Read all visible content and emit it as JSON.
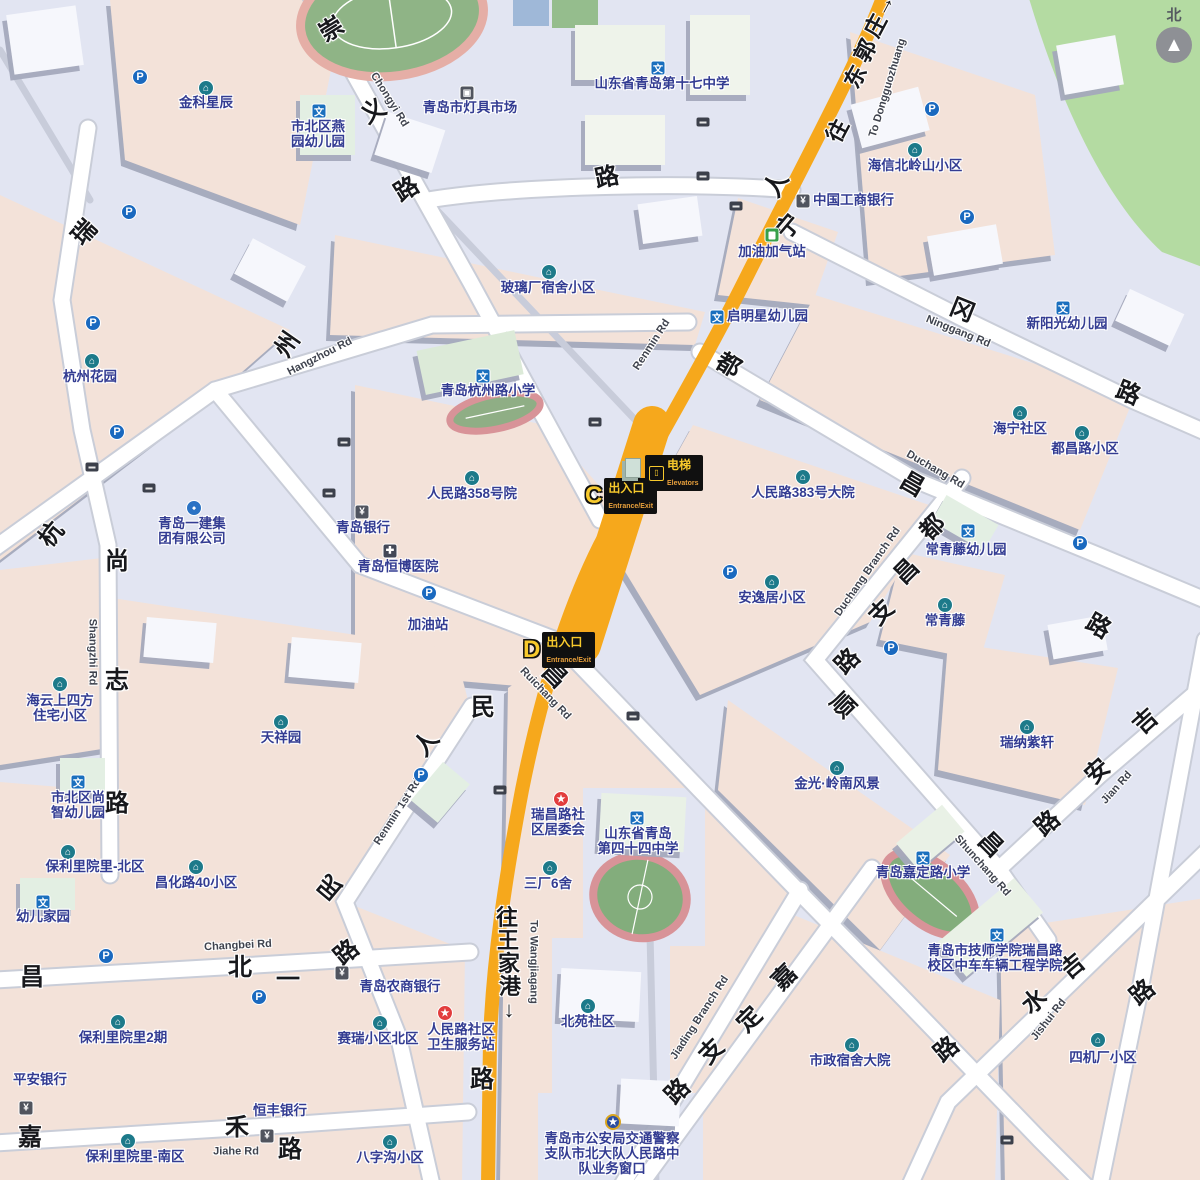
{
  "compass": {
    "label": "北"
  },
  "colors": {
    "background": "#e2e5f2",
    "block_pink": "#f3e2d9",
    "park_green": "#b4dba2",
    "main_road_yellow": "#f6a81c",
    "minor_road": "#ffffff",
    "poi_text": "#333c92",
    "street_text": "#17181c",
    "metro_badge_bg": "#101010",
    "metro_yellow": "#f7c92c"
  },
  "station": {
    "entrance_c": {
      "letter": "C",
      "label": "出入口",
      "sublabel": "Entrance/Exit"
    },
    "entrance_d": {
      "letter": "D",
      "label": "出入口",
      "sublabel": "Entrance/Exit"
    },
    "elevator": {
      "label": "电梯",
      "sublabel": "Elevators"
    }
  },
  "streets": [
    {
      "id": "chongyi-rd",
      "chars": [
        {
          "c": "崇",
          "x": 332,
          "y": 30,
          "r": -32
        },
        {
          "c": "义",
          "x": 374,
          "y": 112,
          "r": -32
        },
        {
          "c": "路",
          "x": 407,
          "y": 190,
          "r": -32
        }
      ],
      "en": {
        "t": "Chongyi Rd",
        "x": 389,
        "y": 100,
        "r": 58
      }
    },
    {
      "id": "rui-char",
      "chars": [
        {
          "c": "瑞",
          "x": 85,
          "y": 233,
          "r": -48
        }
      ]
    },
    {
      "id": "hangzhou-rd",
      "chars": [
        {
          "c": "杭",
          "x": 52,
          "y": 535,
          "r": -50
        },
        {
          "c": "州",
          "x": 288,
          "y": 345,
          "r": -55
        }
      ],
      "en": {
        "t": "Hangzhou Rd",
        "x": 320,
        "y": 357,
        "r": -27
      }
    },
    {
      "id": "shangzhi-rd",
      "chars": [
        {
          "c": "尚",
          "x": 117,
          "y": 562,
          "r": 0
        },
        {
          "c": "志",
          "x": 117,
          "y": 681,
          "r": 0
        },
        {
          "c": "路",
          "x": 117,
          "y": 804,
          "r": 0
        }
      ],
      "en": {
        "t": "Shangzhi Rd",
        "x": 92,
        "y": 652,
        "r": 90
      }
    },
    {
      "id": "lu-top",
      "chars": [
        {
          "c": "路",
          "x": 607,
          "y": 178,
          "r": -12
        }
      ]
    },
    {
      "id": "renmin-rd",
      "chars": [
        {
          "c": "人",
          "x": 777,
          "y": 185,
          "r": -60
        },
        {
          "c": "民",
          "x": 483,
          "y": 708,
          "r": 0
        },
        {
          "c": "路",
          "x": 482,
          "y": 1080,
          "r": 0
        }
      ],
      "en": {
        "t": "Renmin Rd",
        "x": 652,
        "y": 345,
        "r": -57
      }
    },
    {
      "id": "ninggang-rd",
      "chars": [
        {
          "c": "宁",
          "x": 789,
          "y": 227,
          "r": -50
        },
        {
          "c": "冈",
          "x": 962,
          "y": 311,
          "r": 22
        },
        {
          "c": "路",
          "x": 1128,
          "y": 394,
          "r": 22
        }
      ],
      "en": {
        "t": "Ninggang Rd",
        "x": 958,
        "y": 332,
        "r": 22
      }
    },
    {
      "id": "duchang-rd",
      "chars": [
        {
          "c": "都",
          "x": 728,
          "y": 366,
          "r": 30
        },
        {
          "c": "昌",
          "x": 912,
          "y": 485,
          "r": 30
        }
      ],
      "en": {
        "t": "Duchang Rd",
        "x": 935,
        "y": 470,
        "r": 30
      }
    },
    {
      "id": "duchang-branch-rd",
      "chars": [
        {
          "c": "都",
          "x": 933,
          "y": 528,
          "r": -45
        },
        {
          "c": "昌",
          "x": 907,
          "y": 572,
          "r": -45
        },
        {
          "c": "支",
          "x": 882,
          "y": 613,
          "r": -45
        },
        {
          "c": "路",
          "x": 848,
          "y": 662,
          "r": -45
        }
      ],
      "en": {
        "t": "Duchang Branch Rd",
        "x": 868,
        "y": 572,
        "r": -55
      }
    },
    {
      "id": "ruichang-rd",
      "chars": [
        {
          "c": "昌",
          "x": 554,
          "y": 676,
          "r": 45
        }
      ],
      "en": {
        "t": "Ruichang Rd",
        "x": 545,
        "y": 694,
        "r": 46
      }
    },
    {
      "id": "renmin-1st-rd",
      "chars": [
        {
          "c": "人",
          "x": 427,
          "y": 744,
          "r": -50
        },
        {
          "c": "民",
          "x": 330,
          "y": 886,
          "r": -140
        },
        {
          "c": "路",
          "x": 347,
          "y": 953,
          "r": -40
        }
      ],
      "en": {
        "t": "Renmin 1st Rd",
        "x": 398,
        "y": 812,
        "r": -57
      }
    },
    {
      "id": "changbei-rd",
      "chars": [
        {
          "c": "昌",
          "x": 32,
          "y": 978,
          "r": 0
        },
        {
          "c": "北",
          "x": 240,
          "y": 968,
          "r": 0
        },
        {
          "c": "一",
          "x": 288,
          "y": 980,
          "r": 0
        }
      ],
      "en": {
        "t": "Changbei Rd",
        "x": 238,
        "y": 946,
        "r": -3
      }
    },
    {
      "id": "jiahe-rd",
      "chars": [
        {
          "c": "嘉",
          "x": 30,
          "y": 1138,
          "r": 0
        },
        {
          "c": "禾",
          "x": 237,
          "y": 1128,
          "r": 0
        },
        {
          "c": "路",
          "x": 290,
          "y": 1150,
          "r": 0
        }
      ],
      "en": {
        "t": "Jiahe Rd",
        "x": 236,
        "y": 1152,
        "r": 0
      }
    },
    {
      "id": "jiading-branch-rd",
      "chars": [
        {
          "c": "支",
          "x": 712,
          "y": 1052,
          "r": -45
        },
        {
          "c": "路",
          "x": 678,
          "y": 1092,
          "r": -45
        }
      ],
      "en": {
        "t": "Jiading Branch Rd",
        "x": 700,
        "y": 1018,
        "r": -57
      }
    },
    {
      "id": "jiading-rd",
      "chars": [
        {
          "c": "嘉",
          "x": 785,
          "y": 978,
          "r": -45
        },
        {
          "c": "定",
          "x": 750,
          "y": 1020,
          "r": -45
        }
      ]
    },
    {
      "id": "jishui-rd",
      "chars": [
        {
          "c": "吉",
          "x": 1073,
          "y": 967,
          "r": -40
        },
        {
          "c": "水",
          "x": 1035,
          "y": 1002,
          "r": -40
        },
        {
          "c": "路",
          "x": 947,
          "y": 1050,
          "r": -40
        }
      ],
      "en": {
        "t": "Jishui Rd",
        "x": 1049,
        "y": 1020,
        "r": -52
      }
    },
    {
      "id": "shunchang-rd",
      "chars": [
        {
          "c": "顺",
          "x": 842,
          "y": 706,
          "r": 45
        },
        {
          "c": "昌",
          "x": 990,
          "y": 845,
          "r": 45
        }
      ],
      "en": {
        "t": "Shunchang Rd",
        "x": 982,
        "y": 866,
        "r": 48
      }
    },
    {
      "id": "jian-rd",
      "chars": [
        {
          "c": "吉",
          "x": 1146,
          "y": 722,
          "r": -42
        },
        {
          "c": "安",
          "x": 1098,
          "y": 772,
          "r": -42
        },
        {
          "c": "路",
          "x": 1048,
          "y": 824,
          "r": -42
        }
      ],
      "en": {
        "t": "Jian Rd",
        "x": 1117,
        "y": 788,
        "r": -48
      }
    },
    {
      "id": "lu-right-upper",
      "chars": [
        {
          "c": "路",
          "x": 1098,
          "y": 627,
          "r": 30
        }
      ]
    },
    {
      "id": "lu-right-lower",
      "chars": [
        {
          "c": "路",
          "x": 1143,
          "y": 993,
          "r": -40
        }
      ]
    },
    {
      "id": "to-dongguozhuang",
      "dir": true,
      "chars": [
        {
          "c": "往",
          "x": 838,
          "y": 131,
          "r": -62
        },
        {
          "c": "东",
          "x": 856,
          "y": 77,
          "r": -62
        },
        {
          "c": "郭",
          "x": 866,
          "y": 51,
          "r": -62
        },
        {
          "c": "庄",
          "x": 876,
          "y": 26,
          "r": -62
        },
        {
          "c": "→",
          "x": 884,
          "y": 5,
          "r": -62
        }
      ],
      "en": {
        "t": "To Dongguozhuang",
        "x": 888,
        "y": 88,
        "r": -73
      }
    },
    {
      "id": "to-wangjiagang",
      "dir": true,
      "chars": [
        {
          "c": "往",
          "x": 507,
          "y": 918,
          "r": 0
        },
        {
          "c": "王",
          "x": 508,
          "y": 941,
          "r": 0
        },
        {
          "c": "家",
          "x": 509,
          "y": 964,
          "r": 0
        },
        {
          "c": "港",
          "x": 510,
          "y": 987,
          "r": 0
        },
        {
          "c": "↓",
          "x": 509,
          "y": 1010,
          "r": 0
        }
      ],
      "en": {
        "t": "To Wangjiagang",
        "x": 533,
        "y": 962,
        "r": 90
      }
    }
  ],
  "places": [
    {
      "id": "jinke-xingchen",
      "icon": "community",
      "ix": 206,
      "iy": 88,
      "lines": [
        "金科星辰"
      ],
      "tx": 206,
      "ty": 96
    },
    {
      "id": "hangzhou-garden",
      "icon": "community",
      "ix": 92,
      "iy": 361,
      "lines": [
        "杭州花园"
      ],
      "tx": 90,
      "ty": 370
    },
    {
      "id": "haiyun-sifang",
      "icon": "community",
      "ix": 60,
      "iy": 684,
      "lines": [
        "海云上四方",
        "住宅小区"
      ],
      "tx": 60,
      "ty": 694
    },
    {
      "id": "tianxiang-yuan",
      "icon": "community",
      "ix": 281,
      "iy": 722,
      "lines": [
        "天祥园"
      ],
      "tx": 281,
      "ty": 731
    },
    {
      "id": "baoli-north",
      "icon": "community",
      "ix": 68,
      "iy": 852,
      "lines": [
        "保利里院里-北区"
      ],
      "tx": 95,
      "ty": 860
    },
    {
      "id": "changhua-40",
      "icon": "community",
      "ix": 196,
      "iy": 867,
      "lines": [
        "昌化路40小区"
      ],
      "tx": 196,
      "ty": 876
    },
    {
      "id": "baoli-phase2",
      "icon": "community",
      "ix": 118,
      "iy": 1022,
      "lines": [
        "保利里院里2期"
      ],
      "tx": 123,
      "ty": 1031
    },
    {
      "id": "baoli-south",
      "icon": "community",
      "ix": 128,
      "iy": 1141,
      "lines": [
        "保利里院里-南区"
      ],
      "tx": 135,
      "ty": 1150
    },
    {
      "id": "sairui-north",
      "icon": "community",
      "ix": 380,
      "iy": 1023,
      "lines": [
        "赛瑞小区北区"
      ],
      "tx": 378,
      "ty": 1032
    },
    {
      "id": "bazigou",
      "icon": "community",
      "ix": 390,
      "iy": 1142,
      "lines": [
        "八字沟小区"
      ],
      "tx": 390,
      "ty": 1151
    },
    {
      "id": "sanchang-6she",
      "icon": "community",
      "ix": 550,
      "iy": 868,
      "lines": [
        "三厂6舍"
      ],
      "tx": 548,
      "ty": 877
    },
    {
      "id": "beiyuan",
      "icon": "community",
      "ix": 588,
      "iy": 1006,
      "lines": [
        "北苑社区"
      ],
      "tx": 588,
      "ty": 1015
    },
    {
      "id": "jinguang-lingnan",
      "icon": "community",
      "ix": 837,
      "iy": 768,
      "lines": [
        "金光·岭南风景"
      ],
      "tx": 837,
      "ty": 777
    },
    {
      "id": "ruina-zixuan",
      "icon": "community",
      "ix": 1027,
      "iy": 727,
      "lines": [
        "瑞纳紫轩"
      ],
      "tx": 1027,
      "ty": 736
    },
    {
      "id": "changqingteng",
      "icon": "community",
      "ix": 945,
      "iy": 605,
      "lines": [
        "常青藤"
      ],
      "tx": 945,
      "ty": 614
    },
    {
      "id": "haining",
      "icon": "community",
      "ix": 1020,
      "iy": 413,
      "lines": [
        "海宁社区"
      ],
      "tx": 1020,
      "ty": 422
    },
    {
      "id": "duchanglu-xiaoqu",
      "icon": "community",
      "ix": 1082,
      "iy": 433,
      "lines": [
        "都昌路小区"
      ],
      "tx": 1085,
      "ty": 442
    },
    {
      "id": "renminlu-383",
      "icon": "community",
      "ix": 803,
      "iy": 477,
      "lines": [
        "人民路383号大院"
      ],
      "tx": 803,
      "ty": 486
    },
    {
      "id": "anyiju",
      "icon": "community",
      "ix": 772,
      "iy": 582,
      "lines": [
        "安逸居小区"
      ],
      "tx": 772,
      "ty": 591
    },
    {
      "id": "renminlu-358",
      "icon": "community",
      "ix": 472,
      "iy": 478,
      "lines": [
        "人民路358号院"
      ],
      "tx": 472,
      "ty": 487
    },
    {
      "id": "bolichang-sushe",
      "icon": "community",
      "ix": 549,
      "iy": 272,
      "lines": [
        "玻璃厂宿舍小区"
      ],
      "tx": 548,
      "ty": 281
    },
    {
      "id": "haixin-beilingshan",
      "icon": "community",
      "ix": 915,
      "iy": 150,
      "lines": [
        "海信北岭山小区"
      ],
      "tx": 915,
      "ty": 159
    },
    {
      "id": "shizheng-dayuan",
      "icon": "community",
      "ix": 852,
      "iy": 1045,
      "lines": [
        "市政宿舍大院"
      ],
      "tx": 850,
      "ty": 1054
    },
    {
      "id": "sijichang",
      "icon": "community",
      "ix": 1098,
      "iy": 1040,
      "lines": [
        "四机厂小区"
      ],
      "tx": 1103,
      "ty": 1051
    },
    {
      "id": "yijian-group",
      "icon": "company",
      "ix": 194,
      "iy": 508,
      "lines": [
        "青岛一建集",
        "团有限公司"
      ],
      "tx": 192,
      "ty": 517
    },
    {
      "id": "dengju-market",
      "icon": "shop",
      "ix": 467,
      "iy": 93,
      "lines": [
        "青岛市灯具市场"
      ],
      "tx": 470,
      "ty": 101
    },
    {
      "id": "no17-middle-school",
      "icon": "school",
      "ix": 658,
      "iy": 68,
      "lines": [
        "山东省青岛第十七中学"
      ],
      "tx": 662,
      "ty": 77
    },
    {
      "id": "yanyuan-kindergarten",
      "icon": "school",
      "ix": 319,
      "iy": 111,
      "lines": [
        "市北区燕",
        "园幼儿园"
      ],
      "tx": 318,
      "ty": 120
    },
    {
      "id": "hangzhoulu-primary",
      "icon": "school",
      "ix": 483,
      "iy": 376,
      "lines": [
        "青岛杭州路小学"
      ],
      "tx": 488,
      "ty": 384
    },
    {
      "id": "qimingxing-kindergarten",
      "icon": "school",
      "ix": 717,
      "iy": 317,
      "lines": [
        "启明星幼儿园"
      ],
      "tx": 727,
      "ty": 317,
      "side": true
    },
    {
      "id": "xinyangguang-kindergarten",
      "icon": "school",
      "ix": 1063,
      "iy": 308,
      "lines": [
        "新阳光幼儿园"
      ],
      "tx": 1067,
      "ty": 317
    },
    {
      "id": "changqingteng-kindergarten",
      "icon": "school",
      "ix": 968,
      "iy": 531,
      "lines": [
        "常青藤幼儿园"
      ],
      "tx": 966,
      "ty": 543
    },
    {
      "id": "shangzhi-kindergarten",
      "icon": "school",
      "ix": 78,
      "iy": 782,
      "lines": [
        "市北区尚",
        "智幼儿园"
      ],
      "tx": 78,
      "ty": 791
    },
    {
      "id": "youer-jiayuan",
      "icon": "school",
      "ix": 43,
      "iy": 902,
      "lines": [
        "幼儿家园"
      ],
      "tx": 43,
      "ty": 910
    },
    {
      "id": "no44-middle-school",
      "icon": "school",
      "ix": 637,
      "iy": 818,
      "lines": [
        "山东省青岛",
        "第四十四中学"
      ],
      "tx": 638,
      "ty": 827
    },
    {
      "id": "jiadinglu-primary",
      "icon": "school",
      "ix": 923,
      "iy": 858,
      "lines": [
        "青岛嘉定路小学"
      ],
      "tx": 923,
      "ty": 866
    },
    {
      "id": "jishi-college",
      "icon": "school",
      "ix": 997,
      "iy": 935,
      "lines": [
        "青岛市技师学院瑞昌路",
        "校区中车车辆工程学院"
      ],
      "tx": 995,
      "ty": 944
    },
    {
      "id": "ruichanglu-committee",
      "icon": "star",
      "ix": 561,
      "iy": 799,
      "lines": [
        "瑞昌路社",
        "区居委会"
      ],
      "tx": 558,
      "ty": 808
    },
    {
      "id": "renminlu-clinic",
      "icon": "star",
      "ix": 445,
      "iy": 1013,
      "lines": [
        "人民路社区",
        "卫生服务站"
      ],
      "tx": 461,
      "ty": 1023
    },
    {
      "id": "police-service-window",
      "icon": "police",
      "ix": 613,
      "iy": 1122,
      "lines": [
        "青岛市公安局交通警察",
        "支队市北大队人民路中",
        "队业务窗口"
      ],
      "tx": 612,
      "ty": 1132
    },
    {
      "id": "icbc-bank",
      "icon": "bank",
      "ix": 803,
      "iy": 201,
      "lines": [
        "中国工商银行"
      ],
      "tx": 813,
      "ty": 201,
      "side": true
    },
    {
      "id": "qingdao-bank",
      "icon": "bank",
      "ix": 362,
      "iy": 512,
      "lines": [
        "青岛银行"
      ],
      "tx": 363,
      "ty": 521
    },
    {
      "id": "rural-commercial-bank",
      "icon": "bank",
      "ix": 342,
      "iy": 973,
      "lines": [
        "青岛农商银行"
      ],
      "tx": 400,
      "ty": 980
    },
    {
      "id": "pingan-bank",
      "icon": "bank",
      "ix": 26,
      "iy": 1108,
      "lines": [
        "平安银行"
      ],
      "tx": 40,
      "ty": 1073
    },
    {
      "id": "hengfeng-bank",
      "icon": "bank",
      "ix": 267,
      "iy": 1136,
      "lines": [
        "恒丰银行"
      ],
      "tx": 280,
      "ty": 1104
    },
    {
      "id": "hengbo-hospital",
      "icon": "hospital",
      "ix": 390,
      "iy": 551,
      "lines": [
        "青岛恒博医院"
      ],
      "tx": 398,
      "ty": 560
    },
    {
      "id": "gas-station",
      "icon": null,
      "lines": [
        "加油站"
      ],
      "tx": 428,
      "ty": 618
    },
    {
      "id": "gas-cng-station",
      "icon": "gas",
      "ix": 772,
      "iy": 235,
      "lines": [
        "加油加气站"
      ],
      "tx": 772,
      "ty": 245
    }
  ],
  "parking_positions": [
    [
      140,
      77
    ],
    [
      129,
      212
    ],
    [
      93,
      323
    ],
    [
      117,
      432
    ],
    [
      932,
      109
    ],
    [
      967,
      217
    ],
    [
      429,
      593
    ],
    [
      730,
      572
    ],
    [
      891,
      648
    ],
    [
      1080,
      543
    ],
    [
      421,
      775
    ],
    [
      106,
      956
    ],
    [
      259,
      997
    ]
  ],
  "sign_positions": [
    [
      703,
      122
    ],
    [
      703,
      176
    ],
    [
      736,
      206
    ],
    [
      92,
      467
    ],
    [
      149,
      488
    ],
    [
      344,
      442
    ],
    [
      329,
      493
    ],
    [
      595,
      422
    ],
    [
      633,
      716
    ],
    [
      500,
      790
    ],
    [
      1007,
      1140
    ]
  ]
}
